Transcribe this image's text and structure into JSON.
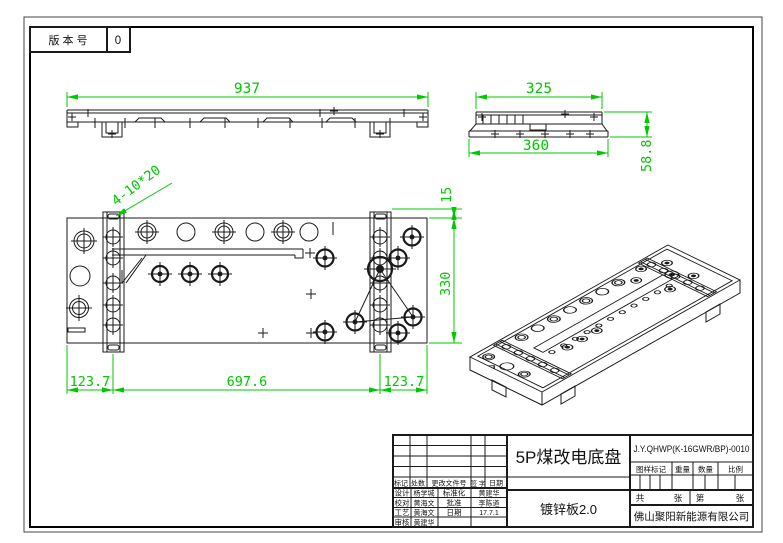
{
  "version_box": {
    "label": "版 本 号",
    "value": "0"
  },
  "dims": {
    "front_width": "937",
    "side_top_width": "325",
    "side_bottom_width": "360",
    "side_height": "58.8",
    "plan_top_offset": "15",
    "plan_height": "330",
    "plan_left_offset": "123.7",
    "plan_span": "697.6",
    "plan_right_offset": "123.7",
    "slot_callout": "4-10*20"
  },
  "title_block": {
    "part_title": "5P煤改电底盘",
    "material": "镀锌板2.0",
    "drawing_code": "J.Y.QHWP(K-16GWR/BP)-0010",
    "company": "佛山聚阳新能源有限公司",
    "revision_headers": [
      "标记",
      "处数",
      "更改文件号",
      "签 字",
      "日期"
    ],
    "stamp_headers": [
      "图样标记",
      "重量",
      "数量",
      "比例"
    ],
    "sheets": {
      "total_label": "共",
      "total_unit": "张",
      "page_label": "第",
      "page_unit": "张"
    },
    "staff_rows": [
      {
        "label": "设计",
        "name": "杨学城",
        "label2": "标准化",
        "name2": "黄建华"
      },
      {
        "label": "校对",
        "name": "黄海文",
        "label2": "批准",
        "name2": "李陈道"
      },
      {
        "label": "工艺",
        "name": "黄海文",
        "label2": "日期",
        "name2": "17.7.1"
      },
      {
        "label": "审核",
        "name": "黄建华",
        "label2": "",
        "name2": ""
      }
    ]
  },
  "colors": {
    "dimension_green": "#00c800",
    "line_black": "#1a1a1a"
  }
}
